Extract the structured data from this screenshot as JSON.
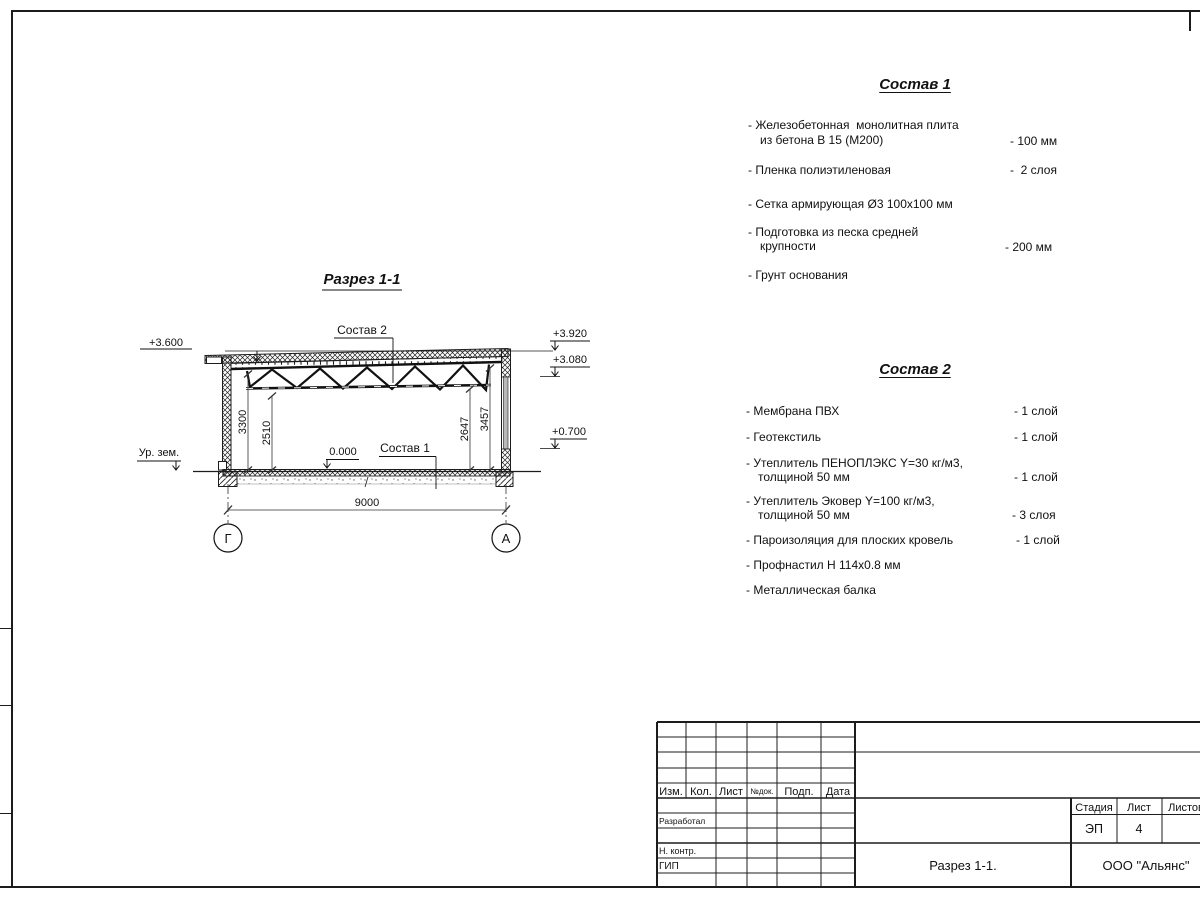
{
  "section": {
    "title": "Разрез 1-1",
    "labels": {
      "sostav2": "Состав 2",
      "sostav1": "Состав 1",
      "zero": "0.000",
      "ground": "Ур. зем."
    },
    "elevations": {
      "left": "+3.600",
      "right_top": "+3.920",
      "right_mid": "+3.080",
      "right_low": "+0.700"
    },
    "dims": {
      "left_outer": "3300",
      "left_inner": "2510",
      "right_inner": "2647",
      "right_outer": "3457",
      "span": "9000"
    },
    "axes": {
      "left": "Г",
      "right": "А"
    }
  },
  "sostav1": {
    "title": "Состав 1",
    "items": [
      {
        "l1": "- Железобетонная  монолитная плита",
        "l2": "из бетона В 15 (М200)",
        "v": "- 100 мм"
      },
      {
        "l1": "- Пленка полиэтиленовая",
        "v": "-  2 слоя"
      },
      {
        "l1": "- Сетка армирующая Ø3 100x100 мм"
      },
      {
        "l1": "- Подготовка из песка средней",
        "l2": "крупности",
        "v": "- 200 мм"
      },
      {
        "l1": "- Грунт основания"
      }
    ]
  },
  "sostav2": {
    "title": "Состав 2",
    "items": [
      {
        "l1": "- Мембрана ПВХ",
        "v": "- 1 слой"
      },
      {
        "l1": "- Геотекстиль",
        "v": "- 1 слой"
      },
      {
        "l1": "- Утеплитель ПЕНОПЛЭКС Y=30 кг/м3,",
        "l2": "толщиной 50 мм",
        "v": "- 1 слой"
      },
      {
        "l1": "- Утеплитель Эковер Y=100 кг/м3,",
        "l2": "толщиной 50 мм",
        "v": "- 3 слоя"
      },
      {
        "l1": "- Пароизоляция для плоских кровель",
        "v": "- 1 слой"
      },
      {
        "l1": "- Профнастил Н 114x0.8 мм"
      },
      {
        "l1": "- Металлическая балка"
      }
    ]
  },
  "title_block": {
    "cols": [
      "Изм.",
      "Кол.",
      "Лист",
      "№док.",
      "Подп.",
      "Дата"
    ],
    "roles": [
      "Разработал",
      "Н. контр.",
      "ГИП"
    ],
    "stage_label": "Стадия",
    "sheet_label": "Лист",
    "sheets_label": "Листов",
    "stage_value": "ЭП",
    "sheet_value": "4",
    "doc_title": "Разрез 1-1.",
    "company": "ООО \"Альянс\""
  }
}
